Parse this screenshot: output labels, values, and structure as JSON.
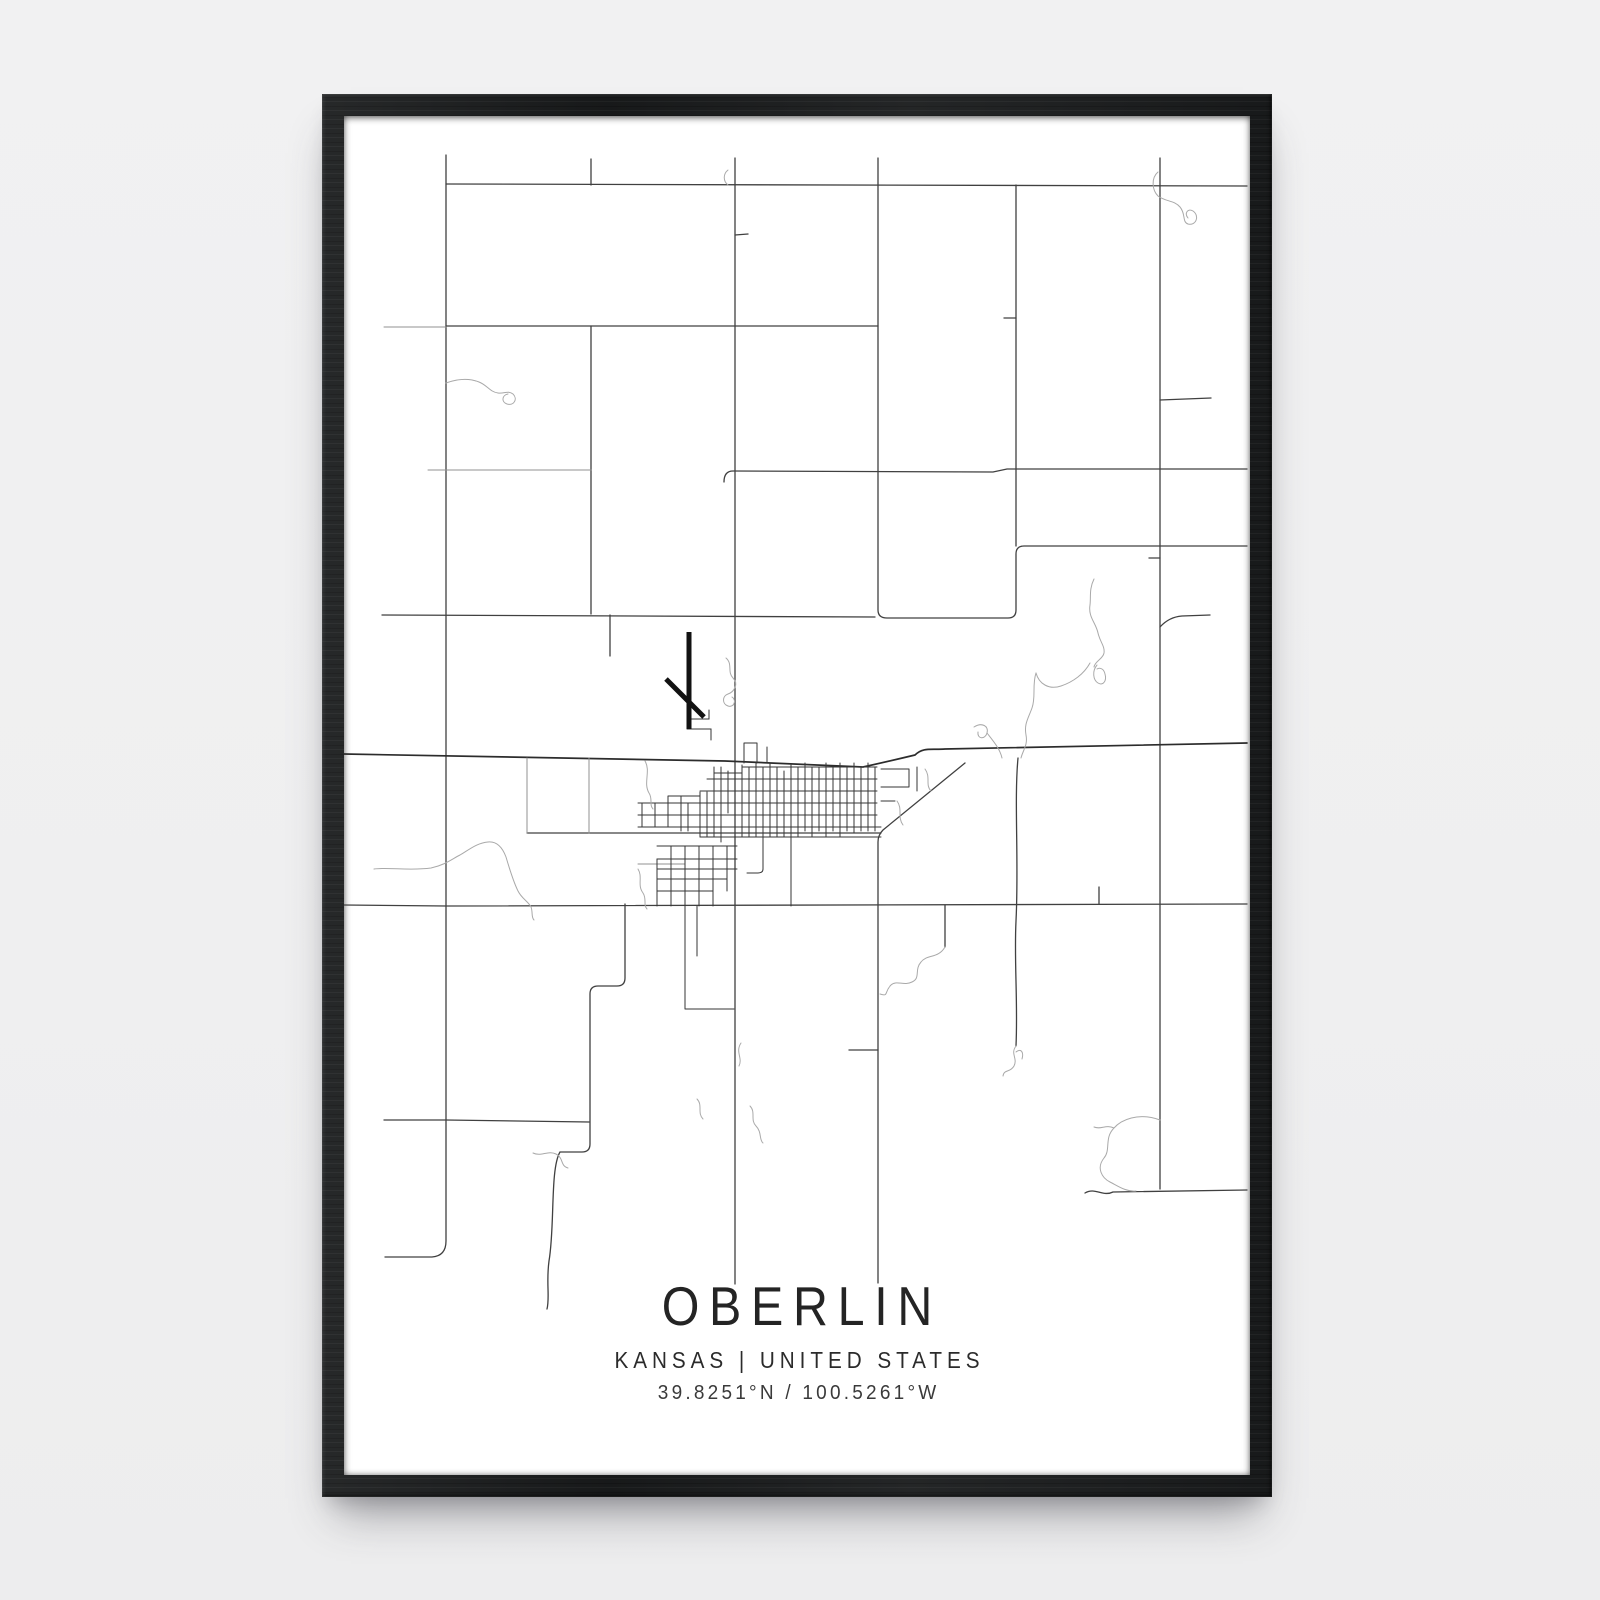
{
  "scene": {
    "background": "#efeff0"
  },
  "frame": {
    "color": "#1b1d1e"
  },
  "poster": {
    "background": "#ffffff",
    "title": "OBERLIN",
    "subtitle": "KANSAS | UNITED STATES",
    "coordinates": "39.8251°N / 100.5261°W",
    "text_color": "#242424"
  },
  "map": {
    "road_color": "#404040",
    "highway_color": "#2c2c2c",
    "minor_road_color": "#929292",
    "city_street_color": "#363636",
    "water_color": "#a9a9a9",
    "runway_color": "#121212",
    "icons": [
      {
        "name": "airport-runways-icon",
        "meaning": "crossed airport runway strips"
      }
    ]
  }
}
